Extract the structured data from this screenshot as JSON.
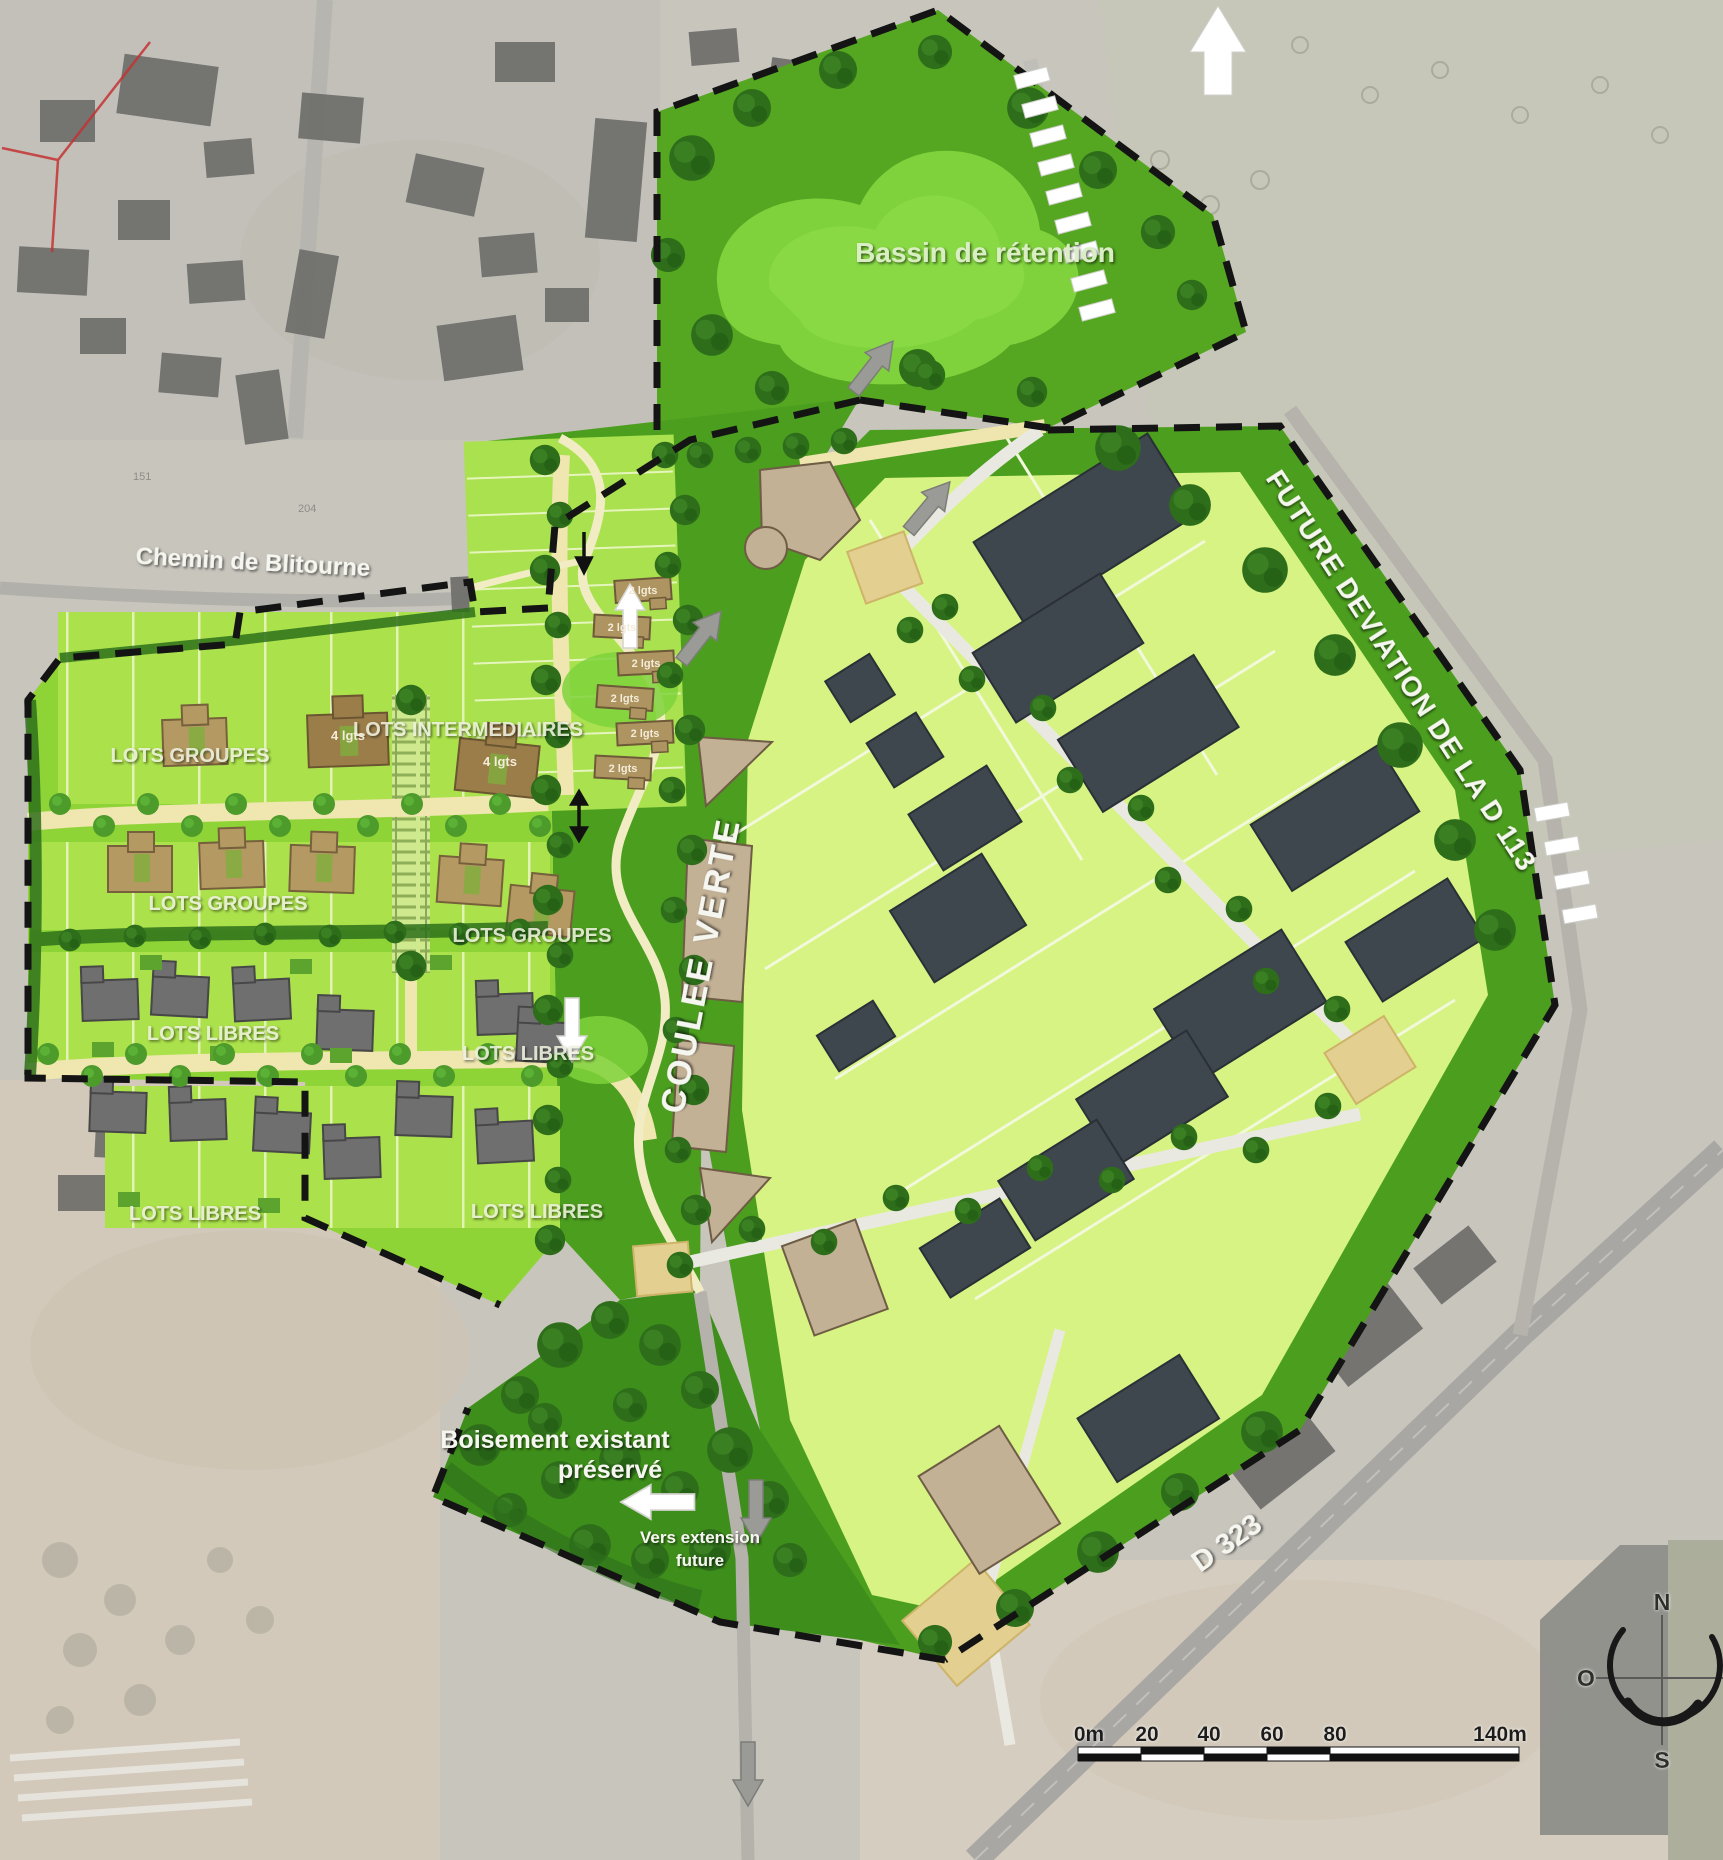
{
  "map": {
    "area_labels": {
      "bassin_retention": "Bassin de rétention",
      "lots_groupes": "LOTS GROUPES",
      "lots_intermediaires": "LOTS INTERMEDIAIRES",
      "lots_libres": "LOTS LIBRES",
      "coulee_verte": "COULEE VERTE",
      "boisement": [
        "Boisement existant",
        "préservé"
      ]
    },
    "road_labels": {
      "chemin_blitourne": "Chemin de Blitourne",
      "future_deviation": "FUTURE DEVIATION DE LA D 113",
      "d323": "D 323"
    },
    "annotations": {
      "vers_extension": [
        "Vers extension",
        "future"
      ],
      "lot_2": "2 lgts",
      "lot_4": "4 lgts",
      "parcel_numbers": [
        "151",
        "204",
        "216"
      ]
    },
    "scale_bar": {
      "ticks": [
        "0m",
        "20",
        "40",
        "60",
        "80",
        "140m"
      ]
    },
    "compass": {
      "north": "N",
      "west": "O",
      "south": "S"
    },
    "colors": {
      "site_green": "#4c9e1f",
      "basin_green": "#7fd23c",
      "parcel_light_green": "#d7f383",
      "residential_green": "#abe14b",
      "building_slate": "#3e464e",
      "building_tan": "#b49a62",
      "building_gray": "#6f6f6f",
      "road_cream": "#efe6b0",
      "boundary_dash": "#141414"
    }
  }
}
